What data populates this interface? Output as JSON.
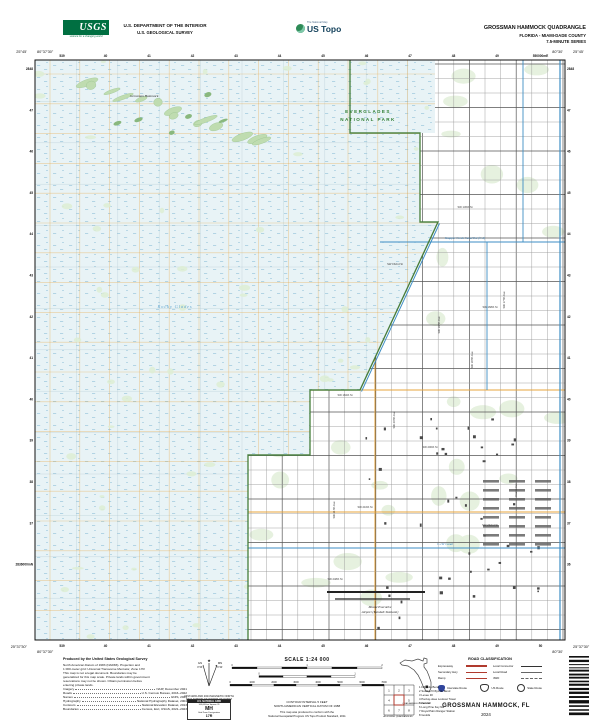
{
  "header": {
    "usgs": {
      "name": "USGS",
      "tagline": "science for a changing world"
    },
    "department_line1": "U.S. DEPARTMENT OF THE INTERIOR",
    "department_line2": "U.S. GEOLOGICAL SURVEY",
    "ustopo": {
      "brand": "US Topo",
      "program": "The National Map"
    },
    "quad_title": "GROSSMAN HAMMOCK QUADRANGLE",
    "quad_subtitle": "FLORIDA - MIAMI-DADE COUNTY",
    "quad_series": "7.5-MINUTE SERIES"
  },
  "map": {
    "colors": {
      "wetland": "#E8F3F6",
      "marsh_dot": "#8FC0D8",
      "veg": "#DDEDD4",
      "veg_dark": "#BFDCB0",
      "veg_edge": "#94C08A",
      "park_boundary": "#3F7A34",
      "canal": "#3E8EC4",
      "road_minor": "#9a9a9a",
      "road_major": "#4a4a4a",
      "road_orange": "#E7A43C",
      "utm_grid": "#A9C2CC",
      "building": "#4a4a4a",
      "red": "#B03A2E",
      "interstate_blue": "#30459C"
    },
    "corner_labels": {
      "top_left_lon": "80°37'30\"",
      "top_left_lat": "25°45'",
      "top_right_lon": "80°30'",
      "top_right_lat": "25°45'",
      "bottom_left_lon": "80°37'30\"",
      "bottom_left_lat": "25°37'30\"",
      "bottom_right_lon": "80°30'",
      "bottom_right_lat": "25°37'30\""
    },
    "top_grid_labels": [
      "539",
      "40",
      "41",
      "42",
      "43",
      "44",
      "45",
      "46",
      "47",
      "48",
      "49",
      "550000mE"
    ],
    "bottom_grid_labels": [
      "539",
      "40",
      "41",
      "42",
      "43",
      "44",
      "45",
      "46",
      "47",
      "48",
      "49",
      "50"
    ],
    "left_grid_labels": [
      "2848",
      "47",
      "46",
      "45",
      "44",
      "43",
      "42",
      "41",
      "40",
      "39",
      "38",
      "37",
      "2836000mN"
    ],
    "right_grid_labels": [
      "2848",
      "47",
      "46",
      "45",
      "44",
      "43",
      "42",
      "41",
      "40",
      "39",
      "38",
      "37",
      "36"
    ],
    "feature_labels": [
      {
        "text": "EVERGLADES",
        "x": 333,
        "y": 53,
        "cls": "lbl-park",
        "anchor": "middle"
      },
      {
        "text": "NATIONAL PARK",
        "x": 333,
        "y": 61,
        "cls": "lbl-park",
        "anchor": "middle"
      },
      {
        "text": "Grossman Hammock",
        "x": 95,
        "y": 37,
        "cls": "lbl-dark"
      },
      {
        "text": "Rocky Glades",
        "x": 140,
        "y": 248,
        "cls": "lbl-water-lg",
        "anchor": "middle"
      },
      {
        "text": "Snapper Creek Canal Ext (C-2)",
        "x": 430,
        "y": 179,
        "cls": "lbl-water",
        "anchor": "middle"
      },
      {
        "text": "C-1W Canal",
        "x": 410,
        "y": 485,
        "cls": "lbl-water",
        "anchor": "middle"
      },
      {
        "text": "Miami Executive",
        "x": 345,
        "y": 548,
        "cls": "lbl-dark",
        "anchor": "middle"
      },
      {
        "text": "Airport (Kendall-Tamiami)",
        "x": 345,
        "y": 553,
        "cls": "lbl-dark",
        "anchor": "middle"
      },
      {
        "text": "SW 136th St",
        "x": 430,
        "y": 148,
        "cls": "lbl-street",
        "anchor": "middle"
      },
      {
        "text": "SW 152nd St",
        "x": 360,
        "y": 205,
        "cls": "lbl-street",
        "anchor": "middle"
      },
      {
        "text": "SW 168th St",
        "x": 455,
        "y": 248,
        "cls": "lbl-street",
        "anchor": "middle"
      },
      {
        "text": "SW 184th St",
        "x": 310,
        "y": 336,
        "cls": "lbl-street",
        "anchor": "middle"
      },
      {
        "text": "SW 200th St",
        "x": 395,
        "y": 388,
        "cls": "lbl-street",
        "anchor": "middle"
      },
      {
        "text": "SW 216th St",
        "x": 330,
        "y": 448,
        "cls": "lbl-street",
        "anchor": "middle"
      },
      {
        "text": "SW 232nd St",
        "x": 455,
        "y": 466,
        "cls": "lbl-street",
        "anchor": "middle"
      },
      {
        "text": "SW 248th St",
        "x": 300,
        "y": 520,
        "cls": "lbl-street",
        "anchor": "middle"
      },
      {
        "text": "SW 177th Ave",
        "x": 470,
        "y": 240,
        "cls": "lbl-street",
        "anchor": "middle",
        "rot": -90
      },
      {
        "text": "SW 187th Ave",
        "x": 438,
        "y": 300,
        "cls": "lbl-street",
        "anchor": "middle",
        "rot": -90
      },
      {
        "text": "SW 197th Ave",
        "x": 405,
        "y": 265,
        "cls": "lbl-street",
        "anchor": "middle",
        "rot": -90
      },
      {
        "text": "SW 207th Ave",
        "x": 360,
        "y": 360,
        "cls": "lbl-street",
        "anchor": "middle",
        "rot": -90
      },
      {
        "text": "SW 217th Ave",
        "x": 300,
        "y": 450,
        "cls": "lbl-street",
        "anchor": "middle",
        "rot": -90
      },
      {
        "text": "Krome Ave",
        "x": 482,
        "y": 430,
        "cls": "lbl-street",
        "anchor": "middle",
        "rot": -90
      }
    ]
  },
  "footer": {
    "produced_by": "Produced by the United States Geological Survey",
    "credit_lines": [
      "North American Datum of 1983 (NAD83). Projection and",
      "1 000-meter grid: Universal Transverse Mercator, Zone 17R",
      "This map is not a legal document. Boundaries may be",
      "generalized for this map scale. Private lands within government",
      "reservations may not be shown. Obtain permission before",
      "entering private lands."
    ],
    "source_lines": [
      {
        "label": "Imagery",
        "value": "NAIP, December 2021"
      },
      {
        "label": "Roads",
        "value": "U.S. Census Bureau, 2016–2022"
      },
      {
        "label": "Names",
        "value": "GNIS, 2024"
      },
      {
        "label": "Hydrography",
        "value": "National Hydrography Dataset, 2004"
      },
      {
        "label": "Contours",
        "value": "National Elevation Dataset, 2013"
      },
      {
        "label": "Boundaries",
        "value": "Census, Esri, USGS, 2021–2023"
      }
    ],
    "declination": {
      "caption1": "UTM GRID AND 2024 MAGNETIC NORTH",
      "caption2": "DECLINATION AT CENTER OF SHEET",
      "gn": "GN",
      "mn": "MN",
      "gn_value": "0°23'",
      "mn_value": "6°44'"
    },
    "usng": {
      "title": "U.S. NATIONAL GRID",
      "square_id_label": "100,000-m Square ID",
      "square_id": "MH",
      "zone_label": "Grid Zone Designation",
      "zone": "17R"
    },
    "scale": {
      "title": "SCALE 1:24 000",
      "bars": [
        {
          "name": "KILOMETERS",
          "ticks": [
            "0",
            "1",
            "2"
          ],
          "width": 150,
          "segments": 6
        },
        {
          "name": "MILES",
          "ticks": [
            "0",
            "1"
          ],
          "width": 96,
          "segments": 4
        },
        {
          "name": "FEET",
          "ticks": [
            "0",
            "1000",
            "2000",
            "3000",
            "4000",
            "5000",
            "6000",
            "7000"
          ],
          "width": 154,
          "segments": 7
        }
      ]
    },
    "contour_line1": "CONTOUR INTERVAL 5 FEET",
    "contour_line2": "NORTH AMERICAN VERTICAL DATUM OF 1988",
    "standard_line1": "This map was produced to conform with the",
    "standard_line2": "National Geospatial Program US Topo Product Standard, 2011",
    "florida_caption": "QUADRANGLE LOCATION",
    "road_class": {
      "title": "ROAD CLASSIFICATION",
      "rows_left": [
        "Expressway",
        "Secondary Hwy",
        "Ramp"
      ],
      "rows_right": [
        "Local Connector",
        "Local Road",
        "4WD"
      ],
      "shields": [
        "Interstate Route",
        "US Route",
        "State Route"
      ]
    },
    "adjoining": {
      "caption": "ADJOINING QUADRANGLES",
      "names": [
        "Fiftymile Bend",
        "South of Fiftymile Bend",
        "Levee 30",
        "Pa-hay-okee Lookout Tower",
        "Kendall",
        "Long Pine Key NE",
        "Royal Palm Ranger Station",
        "Goulds"
      ]
    },
    "sheet_title": "GROSSMAN HAMMOCK, FL",
    "sheet_year": "2024"
  }
}
